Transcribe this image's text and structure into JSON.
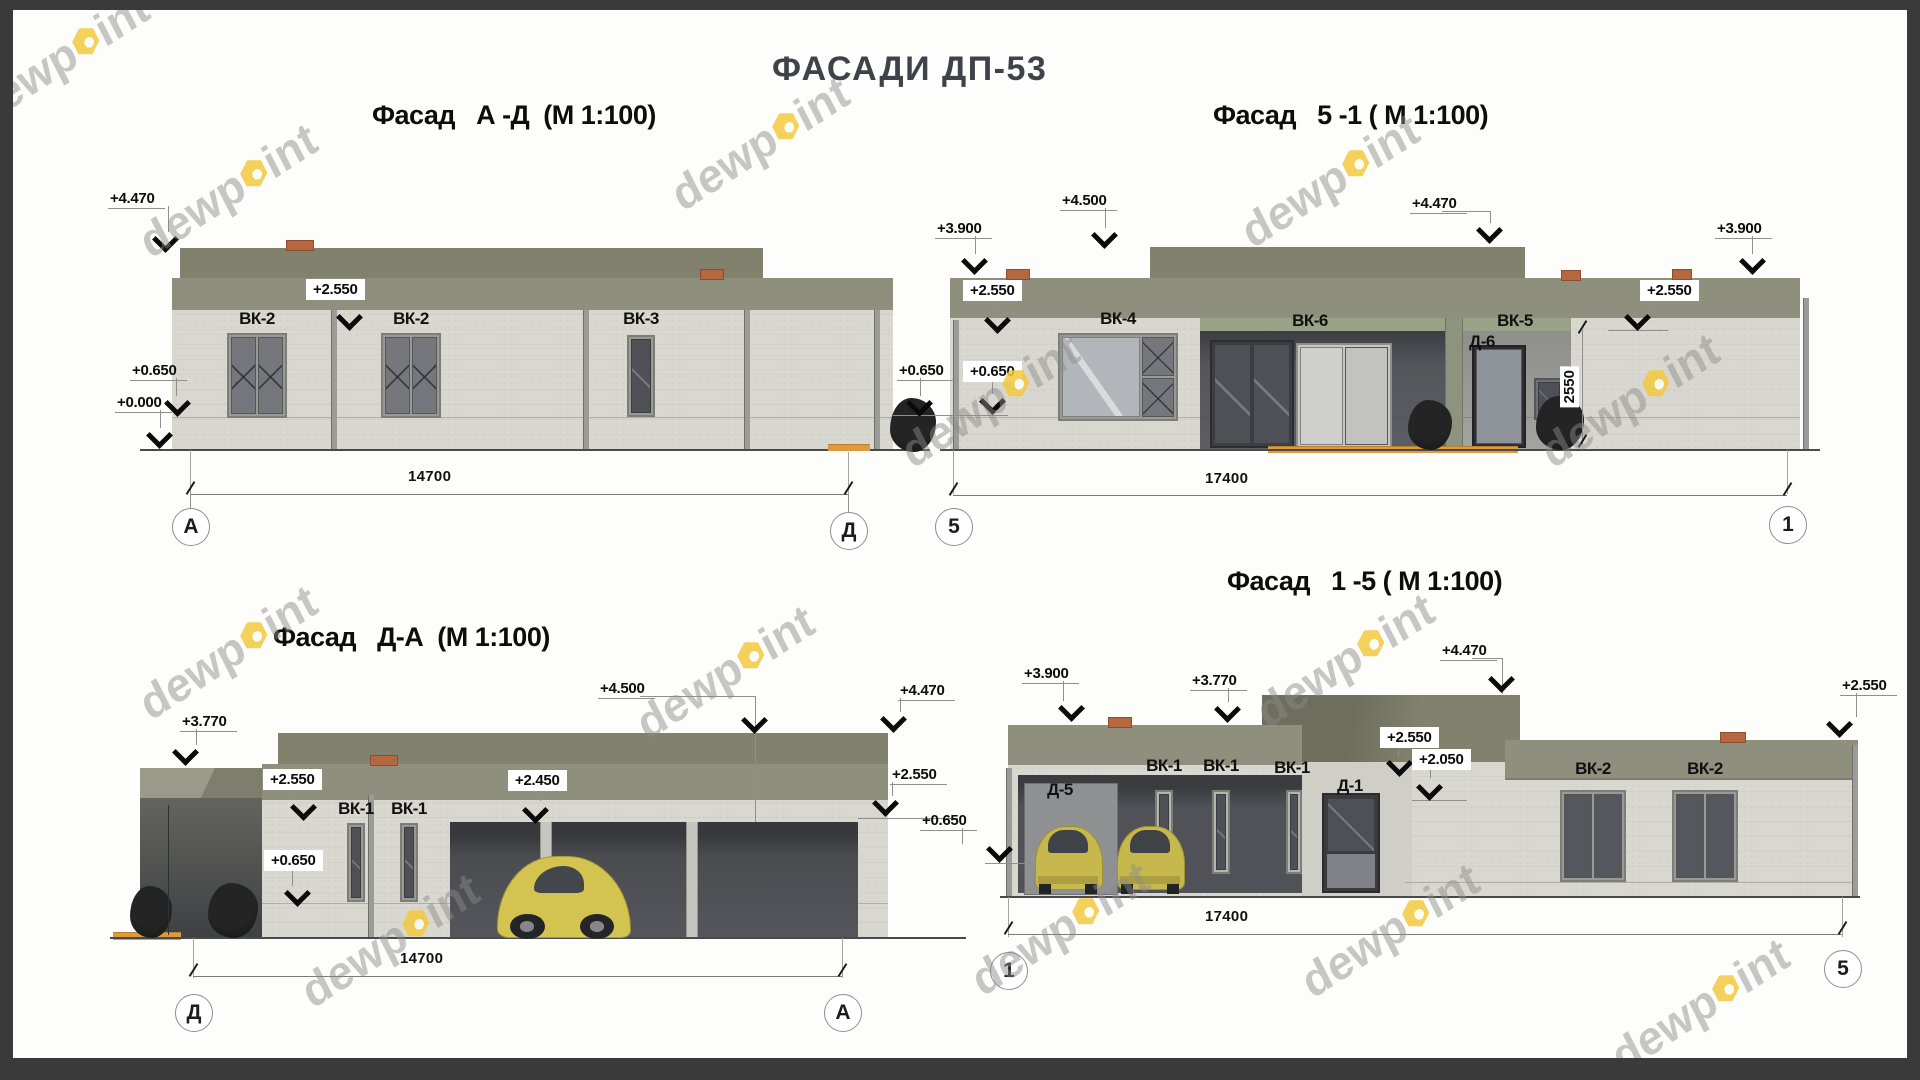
{
  "page": {
    "title": "ФАСАДИ ДП-53"
  },
  "watermark": {
    "pre": "dewp",
    "post": "int"
  },
  "colors": {
    "band_olive": "#8F8F7D",
    "roof_olive": "#81816D",
    "wall": "#D8D8D1",
    "opening_dark": "#515257",
    "step_orange": "#E09A3E",
    "car_yellow": "#D3C452",
    "watermark_yellow": "#F3C93E",
    "title_gray": "#3E434A"
  },
  "f_ad": {
    "title": "Фасад   А -Д  (М 1:100)",
    "lvl_4470": "+4.470",
    "lvl_2550": "+2.550",
    "lvl_0650": "+0.650",
    "lvl_0000": "+0.000",
    "lvl_0650_r": "+0.650",
    "win1": "ВК-2",
    "win2": "ВК-2",
    "win3": "ВК-3",
    "dim": "14700",
    "axis_l": "А",
    "axis_r": "Д"
  },
  "f_51": {
    "title": "Фасад   5 -1 ( М 1:100)",
    "lvl_3900_l": "+3.900",
    "lvl_4500": "+4.500",
    "lvl_4470": "+4.470",
    "lvl_3900_r": "+3.900",
    "lvl_2550_l": "+2.550",
    "lvl_2550_r": "+2.550",
    "lvl_0650": "+0.650",
    "win_vk4": "ВК-4",
    "win_vk6": "ВК-6",
    "win_vk5": "ВК-5",
    "door_d6": "Д-6",
    "vdim": "2550",
    "dim": "17400",
    "axis_l": "5",
    "axis_r": "1"
  },
  "f_da": {
    "title": "Фасад   Д-А  (М 1:100)",
    "lvl_3770": "+3.770",
    "lvl_2550": "+2.550",
    "lvl_0650": "+0.650",
    "lvl_2450": "+2.450",
    "lvl_4500": "+4.500",
    "lvl_4470": "+4.470",
    "lvl_2550_r": "+2.550",
    "win1": "ВК-1",
    "win2": "ВК-1",
    "dim": "14700",
    "axis_l": "Д",
    "axis_r": "А"
  },
  "f_15": {
    "title": "Фасад   1 -5 ( М 1:100)",
    "lvl_3900": "+3.900",
    "lvl_3770": "+3.770",
    "lvl_4470": "+4.470",
    "lvl_2550": "+2.550",
    "lvl_2050": "+2.050",
    "lvl_2550_r": "+2.550",
    "lvl_0650": "+0.650",
    "win1": "ВК-1",
    "win2": "ВК-1",
    "win3": "ВК-1",
    "door_d5": "Д-5",
    "door_d1": "Д-1",
    "win_vk2_1": "ВК-2",
    "win_vk2_2": "ВК-2",
    "dim": "17400",
    "axis_l": "1",
    "axis_r": "5"
  }
}
